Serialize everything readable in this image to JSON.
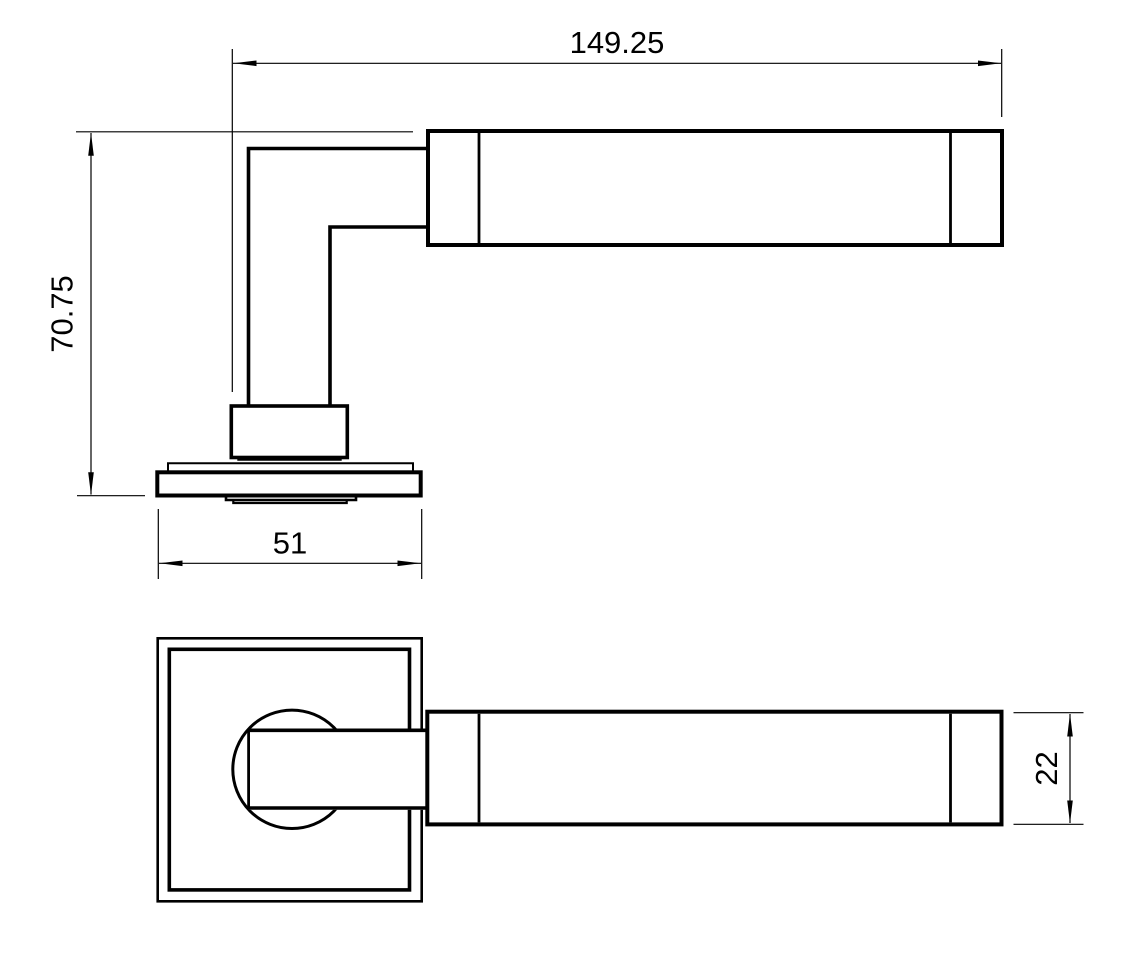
{
  "page": {
    "background_color": "#ffffff",
    "line_color": "#000000"
  },
  "drawing": {
    "side_view": {
      "dim_length": "149.25",
      "dim_height": "70.75",
      "dim_rose_width": "51"
    },
    "front_view": {
      "dim_lever_thickness": "22"
    }
  }
}
